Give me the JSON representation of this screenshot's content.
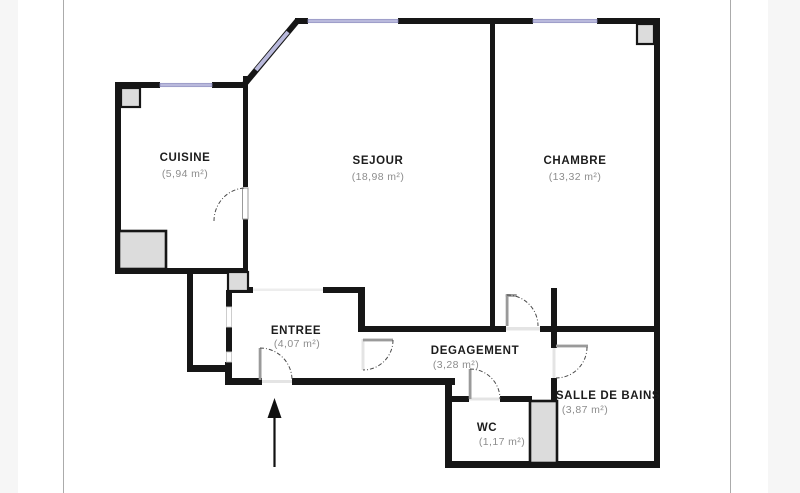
{
  "plan": {
    "rooms": [
      {
        "name": "CUISINE",
        "area": "(5,94 m²)"
      },
      {
        "name": "SEJOUR",
        "area": "(18,98 m²)"
      },
      {
        "name": "CHAMBRE",
        "area": "(13,32 m²)"
      },
      {
        "name": "ENTREE",
        "area": "(4,07 m²)"
      },
      {
        "name": "DEGAGEMENT",
        "area": "(3,28 m²)"
      },
      {
        "name": "SALLE DE BAINS",
        "area": "(3,87 m²)"
      },
      {
        "name": "WC",
        "area": "(1,17 m²)"
      }
    ],
    "icons": [
      "entrance-arrow-icon",
      "window-icon",
      "door-swing-icon",
      "pillar-icon",
      "duct-shaft-icon"
    ],
    "colors": {
      "wall": "#161616",
      "window": "#b9b9dc",
      "window_edge": "#9191c0",
      "pillar": "#dcdcdc",
      "door_leaf": "#9a9a9a",
      "threshold": "#e4e4e4",
      "background": "#ffffff",
      "page_margin": "#f6f6f6",
      "page_edge_line": "#ababab"
    }
  }
}
